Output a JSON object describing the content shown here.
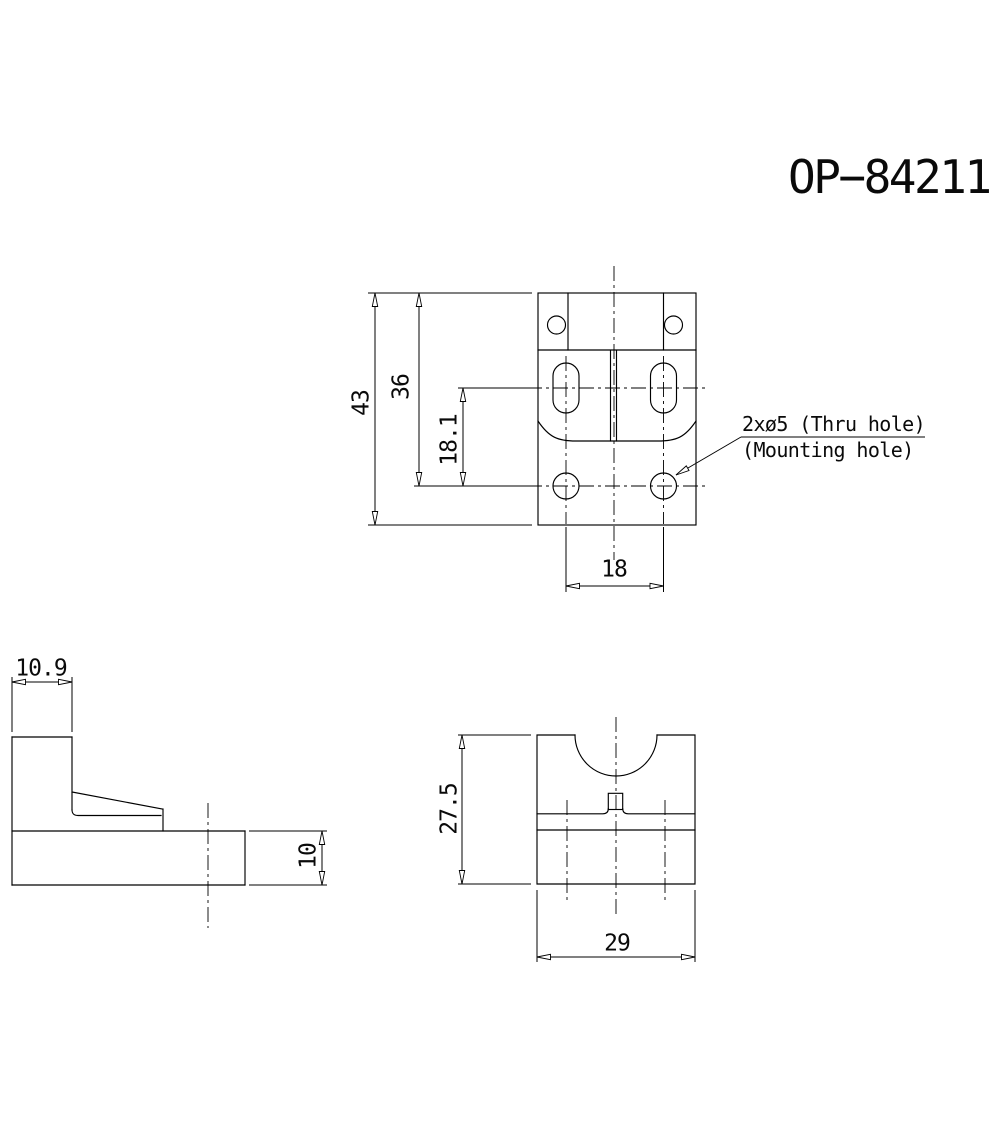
{
  "drawing_number": "OP−84211",
  "callout": {
    "line1": "2xø5 (Thru hole)",
    "line2": "(Mounting hole)"
  },
  "top_view": {
    "overall_height": "43",
    "top_to_mount_hole": "36",
    "slot_to_mount_hole": "18.1",
    "mount_hole_spacing": "18"
  },
  "side_view": {
    "upper_wall_width": "10.9",
    "base_thickness": "10"
  },
  "front_view": {
    "overall_height": "27.5",
    "overall_width": "29"
  },
  "colors": {
    "line": "#000000",
    "background": "#ffffff"
  }
}
